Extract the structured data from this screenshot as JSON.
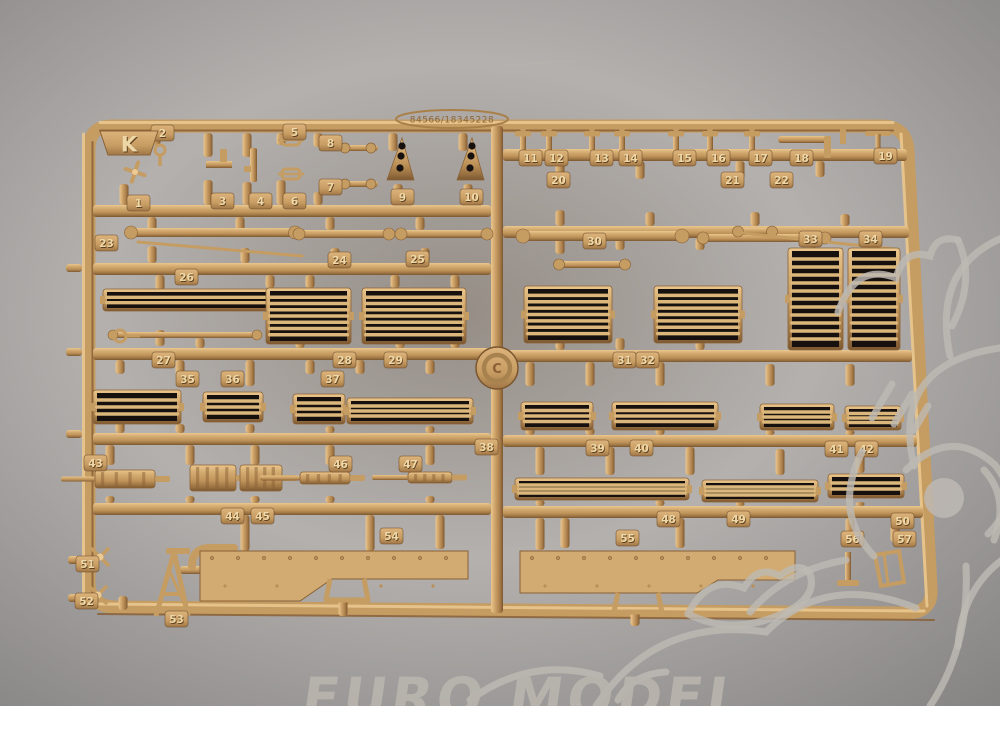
{
  "scene": {
    "description": "Photograph of a tan plastic model-kit parts sprue (frame K) on a dark background with shop watermarks",
    "background_color": "#1b1412",
    "plastic_color": "#c59c62",
    "plastic_highlight": "#ecca92",
    "plastic_shadow": "#8a6136",
    "white_strip_color": "#ffffff",
    "watermark_color": "#bdb9b3"
  },
  "watermark": {
    "text": "EURO MODEL"
  },
  "sprue": {
    "letter": "K",
    "serial": "84566/18345228",
    "medallion_symbol": "C",
    "parts": [
      {
        "n": "1",
        "x": 127,
        "y": 195
      },
      {
        "n": "2",
        "x": 151,
        "y": 125
      },
      {
        "n": "3",
        "x": 211,
        "y": 193
      },
      {
        "n": "4",
        "x": 249,
        "y": 193
      },
      {
        "n": "5",
        "x": 283,
        "y": 124
      },
      {
        "n": "6",
        "x": 283,
        "y": 193
      },
      {
        "n": "7",
        "x": 319,
        "y": 179
      },
      {
        "n": "8",
        "x": 319,
        "y": 135
      },
      {
        "n": "9",
        "x": 391,
        "y": 189
      },
      {
        "n": "10",
        "x": 460,
        "y": 189
      },
      {
        "n": "11",
        "x": 519,
        "y": 150
      },
      {
        "n": "12",
        "x": 545,
        "y": 150
      },
      {
        "n": "13",
        "x": 590,
        "y": 150
      },
      {
        "n": "14",
        "x": 619,
        "y": 150
      },
      {
        "n": "15",
        "x": 673,
        "y": 150
      },
      {
        "n": "16",
        "x": 707,
        "y": 150
      },
      {
        "n": "17",
        "x": 749,
        "y": 150
      },
      {
        "n": "18",
        "x": 790,
        "y": 150
      },
      {
        "n": "19",
        "x": 874,
        "y": 148
      },
      {
        "n": "20",
        "x": 547,
        "y": 172
      },
      {
        "n": "21",
        "x": 721,
        "y": 172
      },
      {
        "n": "22",
        "x": 770,
        "y": 172
      },
      {
        "n": "23",
        "x": 95,
        "y": 235
      },
      {
        "n": "24",
        "x": 328,
        "y": 252
      },
      {
        "n": "25",
        "x": 406,
        "y": 251
      },
      {
        "n": "26",
        "x": 175,
        "y": 269
      },
      {
        "n": "27",
        "x": 152,
        "y": 352
      },
      {
        "n": "28",
        "x": 333,
        "y": 352
      },
      {
        "n": "29",
        "x": 384,
        "y": 352
      },
      {
        "n": "30",
        "x": 583,
        "y": 233
      },
      {
        "n": "31",
        "x": 613,
        "y": 352
      },
      {
        "n": "32",
        "x": 636,
        "y": 352
      },
      {
        "n": "33",
        "x": 799,
        "y": 231
      },
      {
        "n": "34",
        "x": 859,
        "y": 231
      },
      {
        "n": "35",
        "x": 176,
        "y": 371
      },
      {
        "n": "36",
        "x": 221,
        "y": 371
      },
      {
        "n": "37",
        "x": 321,
        "y": 371
      },
      {
        "n": "38",
        "x": 475,
        "y": 439
      },
      {
        "n": "39",
        "x": 586,
        "y": 440
      },
      {
        "n": "40",
        "x": 630,
        "y": 440
      },
      {
        "n": "41",
        "x": 825,
        "y": 441
      },
      {
        "n": "42",
        "x": 855,
        "y": 441
      },
      {
        "n": "43",
        "x": 84,
        "y": 455
      },
      {
        "n": "44",
        "x": 221,
        "y": 508
      },
      {
        "n": "45",
        "x": 251,
        "y": 508
      },
      {
        "n": "46",
        "x": 329,
        "y": 456
      },
      {
        "n": "47",
        "x": 399,
        "y": 456
      },
      {
        "n": "48",
        "x": 657,
        "y": 511
      },
      {
        "n": "49",
        "x": 727,
        "y": 511
      },
      {
        "n": "50",
        "x": 891,
        "y": 513
      },
      {
        "n": "51",
        "x": 76,
        "y": 556
      },
      {
        "n": "52",
        "x": 75,
        "y": 593
      },
      {
        "n": "53",
        "x": 165,
        "y": 611
      },
      {
        "n": "54",
        "x": 380,
        "y": 528
      },
      {
        "n": "55",
        "x": 616,
        "y": 530
      },
      {
        "n": "56",
        "x": 841,
        "y": 531
      },
      {
        "n": "57",
        "x": 893,
        "y": 531
      }
    ],
    "frame_path": "M112,126 H882 Q906,126 908,150 L931,588 Q933,612 908,613 L114,607 Q89,606 89,582 V150 Q89,126 112,126 Z",
    "rails": [
      {
        "x": 491,
        "y": 126,
        "w": 12,
        "h": 487,
        "o": "v"
      },
      {
        "x": 93,
        "y": 205,
        "w": 398,
        "h": 12,
        "o": "h"
      },
      {
        "x": 93,
        "y": 263,
        "w": 398,
        "h": 12,
        "o": "h"
      },
      {
        "x": 93,
        "y": 348,
        "w": 404,
        "h": 12,
        "o": "h"
      },
      {
        "x": 497,
        "y": 350,
        "w": 415,
        "h": 12,
        "o": "h"
      },
      {
        "x": 93,
        "y": 433,
        "w": 398,
        "h": 12,
        "o": "h"
      },
      {
        "x": 93,
        "y": 503,
        "w": 398,
        "h": 12,
        "o": "h"
      },
      {
        "x": 503,
        "y": 149,
        "w": 404,
        "h": 12,
        "o": "h"
      },
      {
        "x": 503,
        "y": 226,
        "w": 406,
        "h": 12,
        "o": "h"
      },
      {
        "x": 503,
        "y": 435,
        "w": 414,
        "h": 12,
        "o": "h"
      },
      {
        "x": 503,
        "y": 506,
        "w": 420,
        "h": 12,
        "o": "h"
      }
    ],
    "accents": [
      [
        100,
        122.5,
        893,
        122.5,
        "hi",
        3
      ],
      [
        100,
        130.5,
        893,
        130.5,
        "sh",
        2
      ],
      [
        83.5,
        134,
        83.5,
        600,
        "hi",
        3
      ],
      [
        92.5,
        142,
        92.5,
        598,
        "sh",
        2
      ],
      [
        901,
        134,
        927,
        606,
        "hi",
        3
      ],
      [
        98,
        604,
        924,
        611,
        "hi",
        3
      ],
      [
        98,
        614,
        934,
        620,
        "sh",
        2
      ]
    ],
    "stubs": [
      [
        124,
        133,
        22
      ],
      [
        156,
        133,
        12
      ],
      [
        208,
        133,
        24
      ],
      [
        247,
        133,
        24
      ],
      [
        281,
        133,
        12
      ],
      [
        318,
        133,
        14
      ],
      [
        393,
        133,
        18
      ],
      [
        463,
        133,
        18
      ],
      [
        124,
        184,
        21
      ],
      [
        208,
        180,
        25
      ],
      [
        247,
        182,
        23
      ],
      [
        281,
        180,
        25
      ],
      [
        318,
        192,
        13
      ],
      [
        398,
        184,
        21
      ],
      [
        468,
        184,
        21
      ],
      [
        152,
        217,
        13
      ],
      [
        240,
        217,
        13
      ],
      [
        330,
        217,
        13
      ],
      [
        420,
        217,
        13
      ],
      [
        152,
        246,
        17
      ],
      [
        245,
        248,
        15
      ],
      [
        335,
        248,
        15
      ],
      [
        425,
        248,
        15
      ],
      [
        560,
        161,
        18
      ],
      [
        640,
        161,
        18
      ],
      [
        740,
        161,
        18
      ],
      [
        820,
        161,
        16
      ],
      [
        560,
        210,
        16
      ],
      [
        650,
        212,
        14
      ],
      [
        755,
        212,
        14
      ],
      [
        845,
        214,
        12
      ],
      [
        160,
        275,
        15
      ],
      [
        270,
        275,
        13
      ],
      [
        310,
        275,
        13
      ],
      [
        395,
        275,
        13
      ],
      [
        455,
        275,
        13
      ],
      [
        160,
        330,
        16
      ],
      [
        200,
        338,
        10
      ],
      [
        300,
        338,
        10
      ],
      [
        400,
        338,
        10
      ],
      [
        455,
        338,
        10
      ],
      [
        560,
        238,
        16
      ],
      [
        620,
        238,
        12
      ],
      [
        700,
        238,
        12
      ],
      [
        812,
        238,
        10
      ],
      [
        868,
        238,
        10
      ],
      [
        560,
        334,
        16
      ],
      [
        620,
        338,
        12
      ],
      [
        700,
        338,
        12
      ],
      [
        530,
        362,
        24
      ],
      [
        590,
        362,
        24
      ],
      [
        660,
        362,
        24
      ],
      [
        770,
        364,
        22
      ],
      [
        850,
        364,
        22
      ],
      [
        530,
        428,
        7
      ],
      [
        590,
        428,
        7
      ],
      [
        660,
        428,
        7
      ],
      [
        770,
        430,
        5
      ],
      [
        850,
        430,
        5
      ],
      [
        120,
        360,
        14
      ],
      [
        180,
        360,
        26
      ],
      [
        250,
        360,
        26
      ],
      [
        310,
        360,
        14
      ],
      [
        360,
        360,
        14
      ],
      [
        430,
        360,
        14
      ],
      [
        120,
        418,
        15
      ],
      [
        180,
        424,
        9
      ],
      [
        250,
        424,
        9
      ],
      [
        330,
        426,
        7
      ],
      [
        430,
        426,
        7
      ],
      [
        110,
        445,
        20
      ],
      [
        190,
        445,
        20
      ],
      [
        255,
        445,
        20
      ],
      [
        330,
        445,
        20
      ],
      [
        430,
        445,
        20
      ],
      [
        110,
        496,
        7
      ],
      [
        190,
        496,
        7
      ],
      [
        255,
        496,
        7
      ],
      [
        330,
        496,
        7
      ],
      [
        430,
        496,
        7
      ],
      [
        540,
        447,
        28
      ],
      [
        610,
        447,
        28
      ],
      [
        690,
        447,
        28
      ],
      [
        780,
        449,
        26
      ],
      [
        860,
        449,
        24
      ],
      [
        540,
        500,
        6
      ],
      [
        660,
        500,
        6
      ],
      [
        740,
        502,
        4
      ],
      [
        860,
        502,
        4
      ],
      [
        245,
        515,
        36
      ],
      [
        370,
        515,
        36
      ],
      [
        440,
        515,
        34
      ],
      [
        540,
        518,
        32
      ],
      [
        565,
        518,
        30
      ],
      [
        680,
        518,
        30
      ],
      [
        850,
        518,
        24
      ],
      [
        895,
        520,
        22
      ],
      [
        343,
        600,
        16
      ],
      [
        635,
        612,
        14
      ],
      [
        123,
        596,
        14
      ]
    ],
    "hstubs": [
      [
        66,
        264,
        16
      ],
      [
        66,
        348,
        16
      ],
      [
        66,
        430,
        16
      ],
      [
        68,
        556,
        14
      ],
      [
        68,
        594,
        14
      ],
      [
        180,
        566,
        22
      ]
    ],
    "rods": [
      {
        "x": 520,
        "y": 231,
        "w": 165,
        "h": 10
      },
      {
        "x": 700,
        "y": 234,
        "w": 128,
        "h": 8
      },
      {
        "x": 128,
        "y": 228,
        "w": 170,
        "h": 9
      },
      {
        "x": 296,
        "y": 230,
        "w": 96,
        "h": 8
      },
      {
        "x": 398,
        "y": 230,
        "w": 92,
        "h": 8
      },
      {
        "x": 110,
        "y": 332,
        "w": 150,
        "h": 6
      },
      {
        "x": 556,
        "y": 261,
        "w": 72,
        "h": 7
      },
      {
        "x": 735,
        "y": 228,
        "w": 40,
        "h": 7
      }
    ],
    "lines": [
      [
        138,
        242,
        302,
        256
      ],
      [
        742,
        233,
        893,
        249
      ]
    ],
    "grilles": [
      {
        "x": 103,
        "y": 289,
        "w": 200,
        "h": 22,
        "b": 2
      },
      {
        "x": 266,
        "y": 288,
        "w": 85,
        "h": 56,
        "b": 7
      },
      {
        "x": 362,
        "y": 288,
        "w": 104,
        "h": 56,
        "b": 7
      },
      {
        "x": 524,
        "y": 286,
        "w": 88,
        "h": 57,
        "b": 7
      },
      {
        "x": 654,
        "y": 286,
        "w": 88,
        "h": 57,
        "b": 7
      },
      {
        "x": 788,
        "y": 248,
        "w": 55,
        "h": 102,
        "b": 11
      },
      {
        "x": 848,
        "y": 248,
        "w": 52,
        "h": 102,
        "b": 11
      },
      {
        "x": 93,
        "y": 390,
        "w": 88,
        "h": 34,
        "b": 3
      },
      {
        "x": 203,
        "y": 392,
        "w": 60,
        "h": 30,
        "b": 3
      },
      {
        "x": 293,
        "y": 394,
        "w": 52,
        "h": 30,
        "b": 3
      },
      {
        "x": 347,
        "y": 398,
        "w": 126,
        "h": 26,
        "b": 3
      },
      {
        "x": 521,
        "y": 402,
        "w": 72,
        "h": 28,
        "b": 3
      },
      {
        "x": 612,
        "y": 402,
        "w": 106,
        "h": 28,
        "b": 3
      },
      {
        "x": 760,
        "y": 404,
        "w": 74,
        "h": 26,
        "b": 3
      },
      {
        "x": 845,
        "y": 406,
        "w": 56,
        "h": 24,
        "b": 3
      },
      {
        "x": 515,
        "y": 478,
        "w": 174,
        "h": 22,
        "b": 3
      },
      {
        "x": 702,
        "y": 480,
        "w": 116,
        "h": 22,
        "b": 3
      },
      {
        "x": 828,
        "y": 474,
        "w": 76,
        "h": 24,
        "b": 2
      }
    ],
    "guns": [
      {
        "x": 95,
        "y": 470,
        "bw": 60,
        "bh": 18,
        "barrel": 34
      },
      {
        "x": 190,
        "y": 465,
        "bw": 46,
        "bh": 26,
        "barrel": 0
      },
      {
        "x": 240,
        "y": 465,
        "bw": 42,
        "bh": 26,
        "barrel": 0
      },
      {
        "x": 300,
        "y": 472,
        "bw": 50,
        "bh": 12,
        "barrel": 40
      },
      {
        "x": 408,
        "y": 472,
        "bw": 44,
        "bh": 11,
        "barrel": 36
      }
    ],
    "smalls": [
      {
        "k": "prop",
        "x": 135,
        "y": 172
      },
      {
        "k": "hook",
        "x": 160,
        "y": 150
      },
      {
        "k": "bkt",
        "x": 218,
        "y": 163
      },
      {
        "k": "gunv",
        "x": 253,
        "y": 168
      },
      {
        "k": "clamp",
        "x": 291,
        "y": 140
      },
      {
        "k": "clamp",
        "x": 291,
        "y": 174
      },
      {
        "k": "dumb",
        "x": 358,
        "y": 148
      },
      {
        "k": "dumb",
        "x": 358,
        "y": 184
      },
      {
        "k": "tri",
        "x": 400,
        "y": 160
      },
      {
        "k": "tri",
        "x": 470,
        "y": 160
      },
      {
        "k": "tpost",
        "x": 523,
        "y": 140
      },
      {
        "k": "tpost",
        "x": 549,
        "y": 140
      },
      {
        "k": "tpost",
        "x": 592,
        "y": 140
      },
      {
        "k": "tpost",
        "x": 622,
        "y": 140
      },
      {
        "k": "tpost",
        "x": 676,
        "y": 140
      },
      {
        "k": "tpost",
        "x": 710,
        "y": 140
      },
      {
        "k": "tpost",
        "x": 752,
        "y": 140
      },
      {
        "k": "elbow",
        "x": 812,
        "y": 140
      },
      {
        "k": "thandle",
        "x": 878,
        "y": 140
      },
      {
        "k": "cross",
        "x": 100,
        "y": 557
      },
      {
        "k": "cross",
        "x": 98,
        "y": 595
      },
      {
        "k": "pipe",
        "x": 212,
        "y": 556
      },
      {
        "k": "jack",
        "x": 172,
        "y": 582
      },
      {
        "k": "foot",
        "x": 848,
        "y": 576
      },
      {
        "k": "sled",
        "x": 888,
        "y": 570
      },
      {
        "k": "eye",
        "x": 120,
        "y": 336
      }
    ],
    "plates": [
      {
        "points": "200,551 468,551 468,579 332,579 300,601 200,601",
        "rx0": 212,
        "rx1": 460,
        "ry": 558
      },
      {
        "points": "520,551 795,551 795,580 718,580 697,593 520,593",
        "rx0": 532,
        "rx1": 786,
        "ry": 558
      }
    ],
    "brackets": [
      "M330,579 L326,600 L368,600 L364,579",
      "M618,593 L614,612 L662,612 L658,593"
    ]
  },
  "mascot": {
    "strokes": [
      "M838,312 q18,-50 58,-34 q8,-30 34,-22 q6,-22 28,-16",
      "M958,240 q18,40 -6,86",
      "M1002,238 q-70,30 -52,118",
      "M1000,348 q-110,16 -86,118",
      "M872,418 l20,-34",
      "M894,424 l18,-30",
      "M914,430 l14,-24",
      "M906,470 q44,-44 88,-6 q30,34 -6,70",
      "M862,452 q-30,60 12,104",
      "M846,560 q-60,10 -96,52",
      "M688,614 q20,-40 56,-26 q14,-24 36,-12 q20,-16 30,-2 q8,24 -28,40 q-50,22 -94,0",
      "M596,706 q60,-90 170,-74 q60,-60 150,-24",
      "M470,700 q60,-44 130,-24",
      "M930,706 q40,-60 36,-140",
      "M1002,560 q-40,30 -44,86",
      "M618,700 q14,-26 48,-28",
      "M984,470 q26,28 10,70"
    ],
    "blob": {
      "cx": 944,
      "cy": 498,
      "r": 20
    }
  }
}
